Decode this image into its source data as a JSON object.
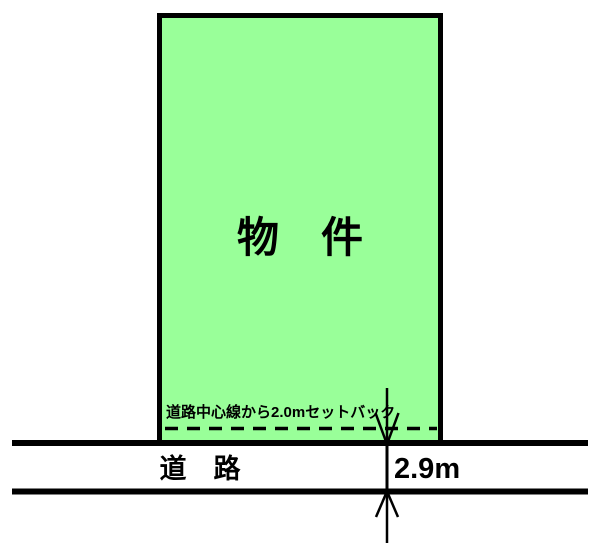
{
  "diagram": {
    "parcel": {
      "label": "物　件",
      "fill": "#99FF99"
    },
    "setback": {
      "label": "道路中心線から2.0mセットバック"
    },
    "road": {
      "label": "道　路",
      "width_label": "2.9m"
    },
    "colors": {
      "line": "#000000",
      "background": "#FFFFFF",
      "parcel_fill": "#99FF99"
    }
  }
}
